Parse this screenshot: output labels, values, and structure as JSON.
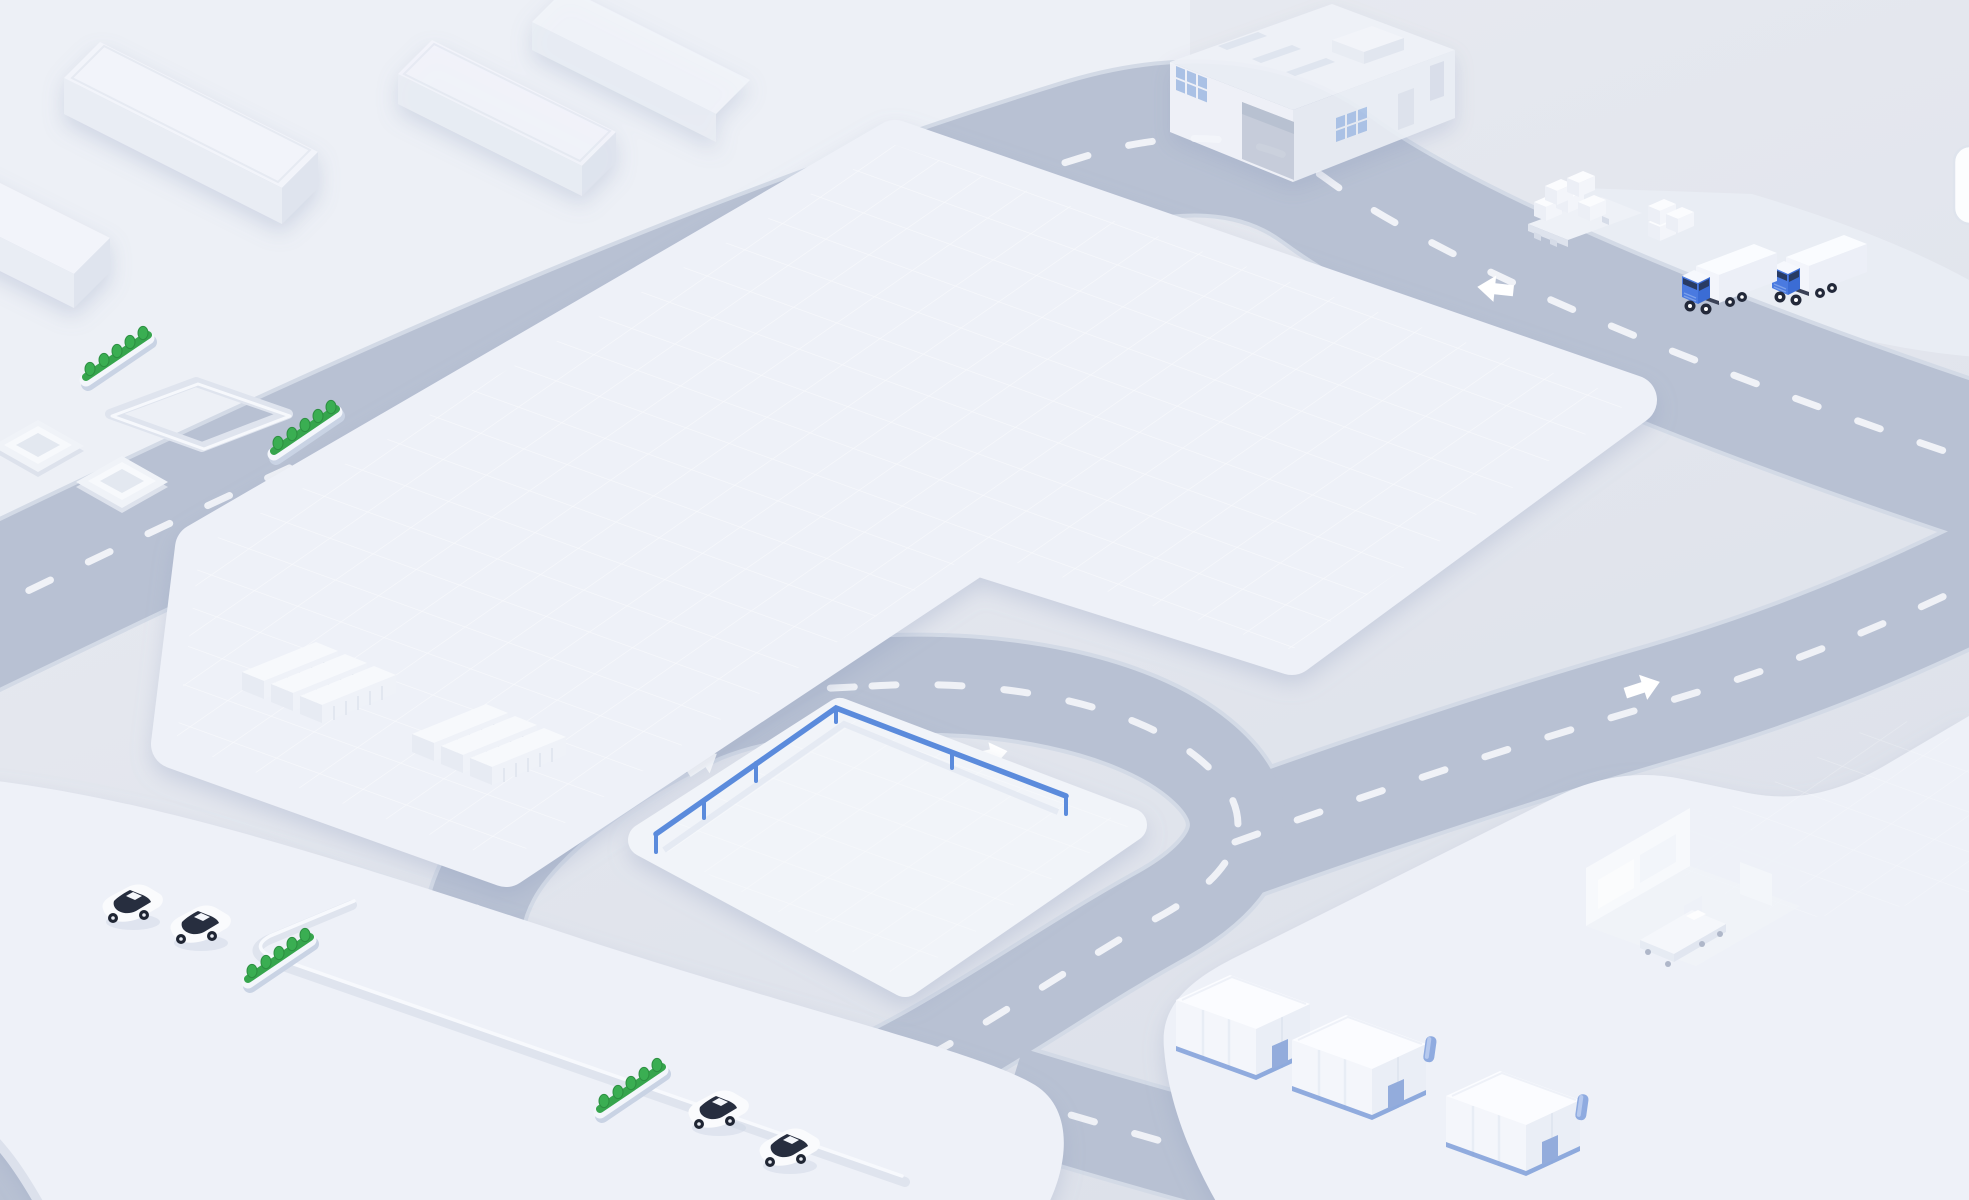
{
  "app": {
    "name": "isometric-logistics-campus-illustration",
    "description": "Isometric 3D illustration of a logistics campus: ring road with dashed lanes and direction arrows, large gridded plaza, railed island, container stacks, factory with loading yard, trucks, pallets, parking lots with cars and hedges, small warehouses and a cutaway patient room",
    "canvas": {
      "width": 1969,
      "height": 1200
    }
  },
  "colors": {
    "background_top": "#eaecf2",
    "background_bottom": "#dde1ea",
    "ground_upper": "#edf0f6",
    "apron": "#e9edf4",
    "road": "#b8c1d3",
    "road_edge": "#d3dae6",
    "road_dash": "#f4f6fa",
    "road_arrow": "#ffffff",
    "plaza": "#eef1f8",
    "grid_line": "#ffffff",
    "island_top": "#f1f4f9",
    "island_side": "#dde3ee",
    "railing_blue": "#5b8bdc",
    "hedge_green": "#36a54d",
    "hedge_green_dark": "#2c8f41",
    "hedge_base": "#f3f6fb",
    "hedge_base_side": "#c9d3e4",
    "building_top": "#f2f4fa",
    "building_side": "#e9edf4",
    "building_end": "#dfe4ee",
    "container_top": "#f7f9fc",
    "container_side": "#eff2f8",
    "container_end": "#e7ebf3",
    "warehouse_trim_blue": "#7e9ed8",
    "warehouse_chimney_blue": "#8fabe0",
    "truck_cab_blue": "#4a7ae0",
    "truck_cab_blue_dark": "#3b6cd4",
    "vehicle_glass": "#272e3f",
    "wheel_dark": "#23293a",
    "factory_window_blue": "#a9c2e7",
    "factory_garage": "#c8cedb",
    "shadow": "#8d9cbf",
    "card_fill": "#fcfdfe",
    "card_border": "#dfe4ed"
  },
  "scene": {
    "roads": {
      "lane_marking": "white dashed center line",
      "segments": [
        {
          "name": "main-road-top",
          "runs": "from left edge northeast to corner, then southeast to right edge"
        },
        {
          "name": "right-road",
          "runs": "from inner loop northeast to right edge"
        },
        {
          "name": "inner-loop-road",
          "runs": "closed loop around railed island"
        },
        {
          "name": "south-exit-road",
          "runs": "from inner loop southeast off bottom edge"
        }
      ],
      "arrows": [
        {
          "name": "arrow-top-road-west",
          "direction": "southwest"
        },
        {
          "name": "arrow-top-road-east",
          "direction": "west"
        },
        {
          "name": "arrow-right-road",
          "direction": "northeast"
        },
        {
          "name": "arrow-loop-west",
          "direction": "northeast"
        },
        {
          "name": "arrow-loop-north",
          "direction": "east-northeast"
        }
      ]
    },
    "plaza": {
      "name": "central-gridded-plaza",
      "surface": "faint white grid",
      "shape": "L-shaped rounded platform"
    },
    "island": {
      "name": "railed-island-platform",
      "railing_sides": 2,
      "railing_posts": 6,
      "surface": "faint white grid"
    },
    "containers": {
      "groups": 2,
      "per_group": 3,
      "style": "white ribbed shipping containers"
    },
    "parking_southwest": {
      "cars": 4,
      "hedges": 2,
      "recessed_outline_path": 1
    },
    "upper_left": {
      "long_buildings": 4,
      "hedges": 2,
      "recessed_pad": 1,
      "stepped_squares": 2
    },
    "factory": {
      "window_grids": 2,
      "garage_door": 1,
      "skylights": 3,
      "rooftop_unit": 1,
      "side_door": 1
    },
    "logistics_yard": {
      "trucks": 2,
      "pallet": 1,
      "box_stacks": 2
    },
    "lower_right": {
      "warehouses": 3,
      "chimneys": 2,
      "cutaway_room": {
        "bed": 1,
        "bed_wheels": 4,
        "cabinets": 3
      }
    },
    "ui": {
      "edge_card": {
        "name": "edge-card",
        "note": "white rounded card partially visible at right edge"
      }
    }
  }
}
